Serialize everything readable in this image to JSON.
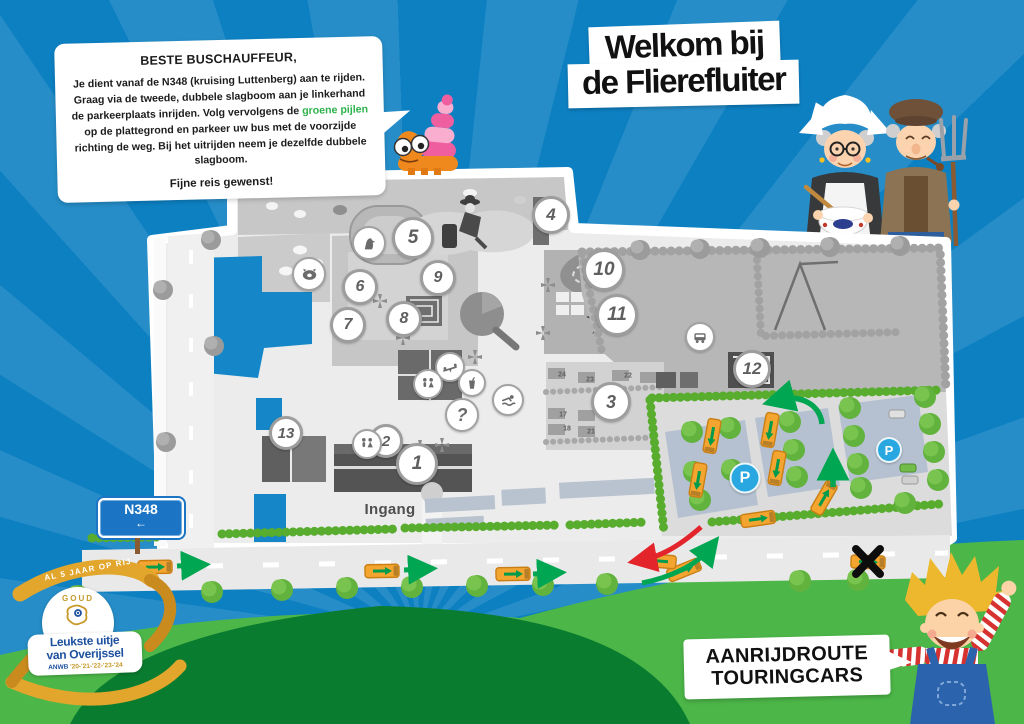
{
  "speech_bubble": {
    "heading": "BESTE BUSCHAUFFEUR,",
    "body_pre": "Je dient vanaf de N348 (kruising Luttenberg) aan te rijden. Graag via de tweede, dubbele slagboom aan je linkerhand de parkeerplaats inrijden. Volg vervolgens de ",
    "body_highlight": "groene pijlen",
    "body_post": " op de plattegrond en parkeer uw bus met de voorzijde richting de weg. Bij het uitrijden neem je dezelfde dubbele slagboom.",
    "closing": "Fijne reis gewenst!"
  },
  "title": {
    "line1": "Welkom bij",
    "line2": "de Flierefluiter"
  },
  "route_box": {
    "line1": "AANRIJDROUTE",
    "line2": "TOURINGCARS"
  },
  "road_sign": {
    "label": "N348",
    "arrow": "←"
  },
  "award_badge": {
    "ribbon_text": "AL 5 JAAR OP RIJ",
    "medal_top": "GOUD",
    "line1": "Leukste uitje",
    "line2": "van Overijssel",
    "org": "ANWB",
    "years": "'20-'21-'22-'23-'24"
  },
  "map": {
    "entrance_label": "Ingang",
    "numbered_markers": [
      {
        "label": "1",
        "x": 417,
        "y": 464,
        "size": 36
      },
      {
        "label": "2",
        "x": 386,
        "y": 441,
        "size": 28
      },
      {
        "label": "3",
        "x": 611,
        "y": 402,
        "size": 34
      },
      {
        "label": "4",
        "x": 551,
        "y": 215,
        "size": 32
      },
      {
        "label": "5",
        "x": 413,
        "y": 238,
        "size": 36
      },
      {
        "label": "6",
        "x": 360,
        "y": 287,
        "size": 30
      },
      {
        "label": "7",
        "x": 348,
        "y": 325,
        "size": 30
      },
      {
        "label": "8",
        "x": 404,
        "y": 319,
        "size": 30
      },
      {
        "label": "9",
        "x": 438,
        "y": 278,
        "size": 30
      },
      {
        "label": "10",
        "x": 604,
        "y": 270,
        "size": 36
      },
      {
        "label": "11",
        "x": 617,
        "y": 315,
        "size": 36
      },
      {
        "label": "12",
        "x": 752,
        "y": 369,
        "size": 32
      },
      {
        "label": "13",
        "x": 286,
        "y": 433,
        "size": 28
      }
    ],
    "icon_markers": [
      {
        "name": "pig-icon",
        "x": 309,
        "y": 274,
        "size": 30
      },
      {
        "name": "horse-icon",
        "x": 369,
        "y": 243,
        "size": 30
      },
      {
        "name": "playground-icon",
        "x": 450,
        "y": 367,
        "size": 26
      },
      {
        "name": "wc-icon",
        "x": 428,
        "y": 384,
        "size": 26
      },
      {
        "name": "drink-icon",
        "x": 472,
        "y": 383,
        "size": 24
      },
      {
        "name": "swim-icon",
        "x": 508,
        "y": 400,
        "size": 28
      },
      {
        "name": "question-icon",
        "x": 462,
        "y": 415,
        "size": 30
      },
      {
        "name": "wc-icon",
        "x": 367,
        "y": 444,
        "size": 26
      },
      {
        "name": "bus-stop-icon",
        "x": 700,
        "y": 337,
        "size": 26
      }
    ],
    "parking_badges": [
      {
        "label": "P",
        "x": 745,
        "y": 478,
        "size": 27
      },
      {
        "label": "P",
        "x": 889,
        "y": 450,
        "size": 22
      }
    ],
    "spot_labels": [
      {
        "label": "24",
        "x": 562,
        "y": 375
      },
      {
        "label": "23",
        "x": 590,
        "y": 380
      },
      {
        "label": "22",
        "x": 628,
        "y": 376
      },
      {
        "label": "17",
        "x": 563,
        "y": 415
      },
      {
        "label": "18",
        "x": 567,
        "y": 429
      },
      {
        "label": "21",
        "x": 591,
        "y": 432
      }
    ]
  },
  "colors": {
    "sky_blue": "#0d80c2",
    "accent_green": "#2eb24c",
    "arrow_green": "#00a651",
    "arrow_red": "#e3242b",
    "bus_orange": "#f4a52f",
    "parking_badge_blue": "#29a7e0",
    "road_sign_blue": "#1b74c4",
    "award_gold": "#e2a62c",
    "award_blue": "#1d509f",
    "hill_light": "#4cb648",
    "hill_dark": "#0a7c30"
  }
}
